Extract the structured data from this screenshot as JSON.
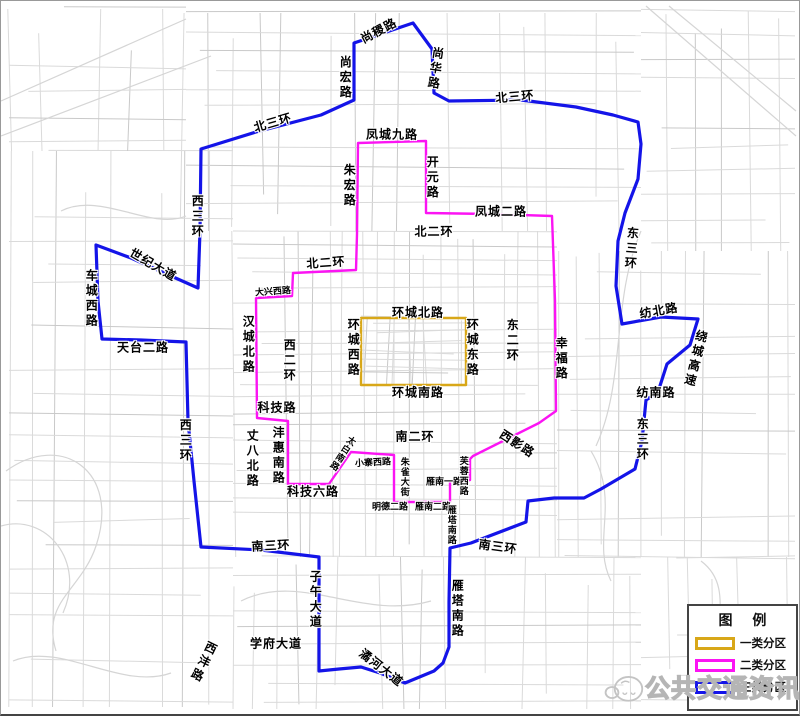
{
  "map": {
    "zones": [
      {
        "name": "一类分区",
        "color": "#d8a718",
        "shape": "rect",
        "rect": {
          "x": 360,
          "y": 317,
          "w": 105,
          "h": 67
        }
      },
      {
        "name": "二类分区",
        "color": "#fb14f3",
        "shape": "polygon",
        "points": [
          [
            357,
            142
          ],
          [
            425,
            140
          ],
          [
            425,
            212
          ],
          [
            490,
            213
          ],
          [
            551,
            215
          ],
          [
            554,
            300
          ],
          [
            555,
            410
          ],
          [
            538,
            422
          ],
          [
            472,
            455
          ],
          [
            469,
            458
          ],
          [
            469,
            479
          ],
          [
            449,
            480
          ],
          [
            449,
            501
          ],
          [
            393,
            501
          ],
          [
            393,
            454
          ],
          [
            350,
            451
          ],
          [
            328,
            483
          ],
          [
            287,
            483
          ],
          [
            287,
            420
          ],
          [
            256,
            417
          ],
          [
            255,
            297
          ],
          [
            291,
            295
          ],
          [
            292,
            272
          ],
          [
            355,
            269
          ],
          [
            356,
            233
          ]
        ]
      },
      {
        "name": "三类分区",
        "color": "#1414e8",
        "shape": "polygon",
        "points": [
          [
            200,
            148
          ],
          [
            255,
            131
          ],
          [
            320,
            114
          ],
          [
            353,
            99
          ],
          [
            353,
            42
          ],
          [
            412,
            22
          ],
          [
            431,
            48
          ],
          [
            433,
            92
          ],
          [
            448,
            100
          ],
          [
            520,
            99
          ],
          [
            575,
            106
          ],
          [
            612,
            114
          ],
          [
            637,
            121
          ],
          [
            640,
            143
          ],
          [
            637,
            178
          ],
          [
            624,
            212
          ],
          [
            617,
            240
          ],
          [
            615,
            285
          ],
          [
            621,
            323
          ],
          [
            660,
            316
          ],
          [
            697,
            318
          ],
          [
            689,
            344
          ],
          [
            666,
            363
          ],
          [
            657,
            391
          ],
          [
            645,
            399
          ],
          [
            641,
            440
          ],
          [
            634,
            468
          ],
          [
            600,
            488
          ],
          [
            583,
            497
          ],
          [
            553,
            497
          ],
          [
            527,
            500
          ],
          [
            525,
            521
          ],
          [
            470,
            542
          ],
          [
            449,
            547
          ],
          [
            448,
            601
          ],
          [
            448,
            646
          ],
          [
            442,
            662
          ],
          [
            433,
            670
          ],
          [
            404,
            682
          ],
          [
            379,
            672
          ],
          [
            360,
            666
          ],
          [
            338,
            668
          ],
          [
            318,
            670
          ],
          [
            318,
            620
          ],
          [
            318,
            556
          ],
          [
            260,
            549
          ],
          [
            200,
            546
          ],
          [
            193,
            480
          ],
          [
            187,
            420
          ],
          [
            185,
            341
          ],
          [
            140,
            339
          ],
          [
            101,
            338
          ],
          [
            97,
            300
          ],
          [
            95,
            244
          ],
          [
            130,
            257
          ],
          [
            170,
            275
          ],
          [
            197,
            287
          ],
          [
            199,
            230
          ]
        ]
      }
    ],
    "road_labels": [
      {
        "text": "尚稷路",
        "x": 378,
        "y": 30,
        "dir": "h",
        "rot": -28,
        "size": "m"
      },
      {
        "text": "尚宏路",
        "x": 344,
        "y": 77,
        "dir": "v",
        "rot": 0,
        "size": "m"
      },
      {
        "text": "尚华路",
        "x": 434,
        "y": 68,
        "dir": "v",
        "rot": 8,
        "size": "m"
      },
      {
        "text": "北三环",
        "x": 514,
        "y": 96,
        "dir": "h",
        "rot": -5,
        "size": "m"
      },
      {
        "text": "北三环",
        "x": 272,
        "y": 122,
        "dir": "h",
        "rot": -16,
        "size": "m"
      },
      {
        "text": "西三环",
        "x": 196,
        "y": 216,
        "dir": "v",
        "rot": 0,
        "size": "m"
      },
      {
        "text": "世纪大道",
        "x": 152,
        "y": 264,
        "dir": "h",
        "rot": 30,
        "size": "m"
      },
      {
        "text": "车城西路",
        "x": 90,
        "y": 298,
        "dir": "v",
        "rot": 0,
        "size": "m"
      },
      {
        "text": "天台二路",
        "x": 142,
        "y": 347,
        "dir": "h",
        "rot": 0,
        "size": "m"
      },
      {
        "text": "西三环",
        "x": 184,
        "y": 440,
        "dir": "v",
        "rot": 0,
        "size": "m"
      },
      {
        "text": "南三环",
        "x": 270,
        "y": 545,
        "dir": "h",
        "rot": -3,
        "size": "m"
      },
      {
        "text": "子午大道",
        "x": 314,
        "y": 599,
        "dir": "v",
        "rot": 0,
        "size": "m"
      },
      {
        "text": "学府大道",
        "x": 275,
        "y": 643,
        "dir": "h",
        "rot": 0,
        "size": "m"
      },
      {
        "text": "西沣路",
        "x": 202,
        "y": 661,
        "dir": "v",
        "rot": 26,
        "size": "m"
      },
      {
        "text": "潏河大道",
        "x": 380,
        "y": 667,
        "dir": "h",
        "rot": 38,
        "size": "m"
      },
      {
        "text": "雁塔南路",
        "x": 456,
        "y": 608,
        "dir": "v",
        "rot": 0,
        "size": "m"
      },
      {
        "text": "南三环",
        "x": 497,
        "y": 546,
        "dir": "h",
        "rot": 8,
        "size": "m"
      },
      {
        "text": "东三环",
        "x": 641,
        "y": 439,
        "dir": "v",
        "rot": 0,
        "size": "m"
      },
      {
        "text": "纺南路",
        "x": 655,
        "y": 392,
        "dir": "h",
        "rot": 0,
        "size": "m"
      },
      {
        "text": "绕城高速",
        "x": 694,
        "y": 358,
        "dir": "v",
        "rot": 14,
        "size": "m"
      },
      {
        "text": "纺北路",
        "x": 658,
        "y": 310,
        "dir": "h",
        "rot": -10,
        "size": "m"
      },
      {
        "text": "东三环",
        "x": 630,
        "y": 248,
        "dir": "v",
        "rot": 4,
        "size": "m"
      },
      {
        "text": "凤城九路",
        "x": 391,
        "y": 134,
        "dir": "h",
        "rot": 0,
        "size": "m"
      },
      {
        "text": "朱宏路",
        "x": 348,
        "y": 185,
        "dir": "v",
        "rot": 0,
        "size": "m"
      },
      {
        "text": "开元路",
        "x": 431,
        "y": 177,
        "dir": "v",
        "rot": 0,
        "size": "m"
      },
      {
        "text": "凤城二路",
        "x": 500,
        "y": 211,
        "dir": "h",
        "rot": 0,
        "size": "m"
      },
      {
        "text": "北二环",
        "x": 433,
        "y": 231,
        "dir": "h",
        "rot": 0,
        "size": "m"
      },
      {
        "text": "北二环",
        "x": 325,
        "y": 262,
        "dir": "h",
        "rot": -4,
        "size": "m"
      },
      {
        "text": "大兴西路",
        "x": 272,
        "y": 291,
        "dir": "h",
        "rot": -4,
        "size": "s"
      },
      {
        "text": "汉城北路",
        "x": 247,
        "y": 344,
        "dir": "v",
        "rot": 0,
        "size": "m"
      },
      {
        "text": "西二环",
        "x": 288,
        "y": 360,
        "dir": "v",
        "rot": 0,
        "size": "m"
      },
      {
        "text": "东二环",
        "x": 511,
        "y": 340,
        "dir": "v",
        "rot": 0,
        "size": "m"
      },
      {
        "text": "幸福路",
        "x": 560,
        "y": 358,
        "dir": "v",
        "rot": 0,
        "size": "m"
      },
      {
        "text": "科技路",
        "x": 276,
        "y": 407,
        "dir": "h",
        "rot": 0,
        "size": "m"
      },
      {
        "text": "丈八北路",
        "x": 251,
        "y": 458,
        "dir": "v",
        "rot": 0,
        "size": "m"
      },
      {
        "text": "沣惠南路",
        "x": 277,
        "y": 455,
        "dir": "v",
        "rot": 0,
        "size": "m"
      },
      {
        "text": "科技六路",
        "x": 312,
        "y": 491,
        "dir": "h",
        "rot": 0,
        "size": "m"
      },
      {
        "text": "太白南路",
        "x": 341,
        "y": 452,
        "dir": "v",
        "rot": 33,
        "size": "s"
      },
      {
        "text": "小寨西路",
        "x": 372,
        "y": 462,
        "dir": "h",
        "rot": -3,
        "size": "s"
      },
      {
        "text": "南二环",
        "x": 414,
        "y": 436,
        "dir": "h",
        "rot": 0,
        "size": "m"
      },
      {
        "text": "朱雀大街",
        "x": 403,
        "y": 476,
        "dir": "v",
        "rot": 0,
        "size": "s"
      },
      {
        "text": "明德二路",
        "x": 389,
        "y": 506,
        "dir": "h",
        "rot": 0,
        "size": "s"
      },
      {
        "text": "雁南二路",
        "x": 432,
        "y": 506,
        "dir": "h",
        "rot": 0,
        "size": "s"
      },
      {
        "text": "雁南一路",
        "x": 443,
        "y": 481,
        "dir": "h",
        "rot": 0,
        "size": "s"
      },
      {
        "text": "雁塔南路",
        "x": 450,
        "y": 524,
        "dir": "v",
        "rot": 0,
        "size": "s"
      },
      {
        "text": "芙蓉西路",
        "x": 462,
        "y": 475,
        "dir": "v",
        "rot": 0,
        "size": "s"
      },
      {
        "text": "西影路",
        "x": 516,
        "y": 443,
        "dir": "h",
        "rot": 33,
        "size": "m"
      },
      {
        "text": "环城北路",
        "x": 417,
        "y": 312,
        "dir": "h",
        "rot": 0,
        "size": "m"
      },
      {
        "text": "环城西路",
        "x": 352,
        "y": 347,
        "dir": "v",
        "rot": 0,
        "size": "m"
      },
      {
        "text": "环城东路",
        "x": 471,
        "y": 347,
        "dir": "v",
        "rot": 0,
        "size": "m"
      },
      {
        "text": "环城南路",
        "x": 417,
        "y": 392,
        "dir": "h",
        "rot": 0,
        "size": "m"
      }
    ]
  },
  "legend": {
    "title": "图 例",
    "items": [
      {
        "label": "一类分区",
        "color": "#d8a718"
      },
      {
        "label": "二类分区",
        "color": "#fb14f3"
      },
      {
        "label": "三类分区",
        "color": "#1414e8"
      }
    ]
  },
  "watermark": {
    "text": "公共交通资讯"
  }
}
